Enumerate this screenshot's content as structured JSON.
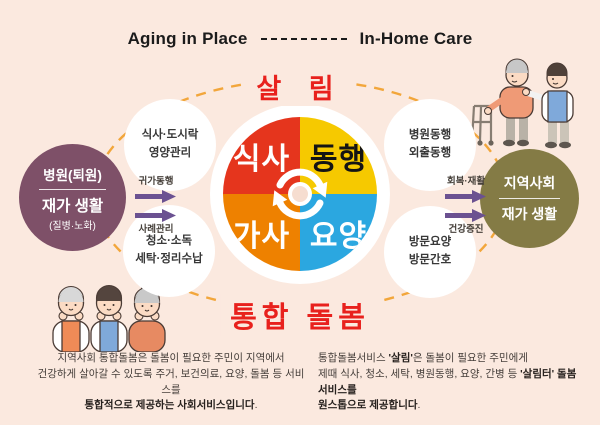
{
  "colors": {
    "background": "#fbe9df",
    "title_text": "#1b1b1b",
    "accent_red": "#e8211d",
    "ellipse_orange": "#f2a63b",
    "arrow_purple": "#6b5191",
    "pie_center_dot": "#f6ddd0"
  },
  "header": {
    "left_title": "Aging in Place",
    "right_title": "In-Home Care"
  },
  "diagram": {
    "top_label": "살 림",
    "bottom_label": "통합 돌봄",
    "pie": {
      "segments": [
        {
          "label": "식사",
          "color": "#e5351d"
        },
        {
          "label": "동행",
          "color": "#f6c900"
        },
        {
          "label": "가사",
          "color": "#ee8100"
        },
        {
          "label": "요양",
          "color": "#2ba7e0"
        }
      ]
    },
    "satellites": {
      "top_left": {
        "line1": "식사·도시락",
        "line2": "영양관리"
      },
      "bottom_left": {
        "line1": "청소·소독",
        "line2": "세탁·정리수납"
      },
      "top_right": {
        "line1": "병원동행",
        "line2": "외출동행"
      },
      "bottom_right": {
        "line1": "방문요양",
        "line2": "방문간호"
      }
    },
    "left_node": {
      "line1": "병원(퇴원)",
      "line2": "재가 생활",
      "line3": "(질병·노화)",
      "color": "#7e5068"
    },
    "right_node": {
      "line1": "지역사회",
      "line2": "재가 생활",
      "color": "#847b45"
    },
    "left_arrows": {
      "top_label": "귀가동행",
      "bottom_label": "사례관리"
    },
    "right_arrows": {
      "top_label": "회복·재활",
      "bottom_label": "건강증진"
    }
  },
  "footer": {
    "left": {
      "line1": "지역사회 통합돌봄은 돌봄이 필요한 주민이 지역에서",
      "line2": "건강하게 살아갈 수 있도록 주거, 보건의료, 요양, 돌봄 등 서비스를",
      "line3_bold": "통합적으로 제공하는 사회서비스입니다",
      "line3_end": "."
    },
    "right": {
      "line1_pre": "통합돌봄서비스 ",
      "line1_bold": "'살림'",
      "line1_post": "은 돌봄이 필요한 주민에게",
      "line2_pre": "제때 식사, 청소, 세탁, 병원동행, 요양, 간병 등 ",
      "line2_bold": "'살림터' 돌봄서비스를",
      "line3_bold": "원스톱으로 제공합니다",
      "line3_end": "."
    }
  }
}
